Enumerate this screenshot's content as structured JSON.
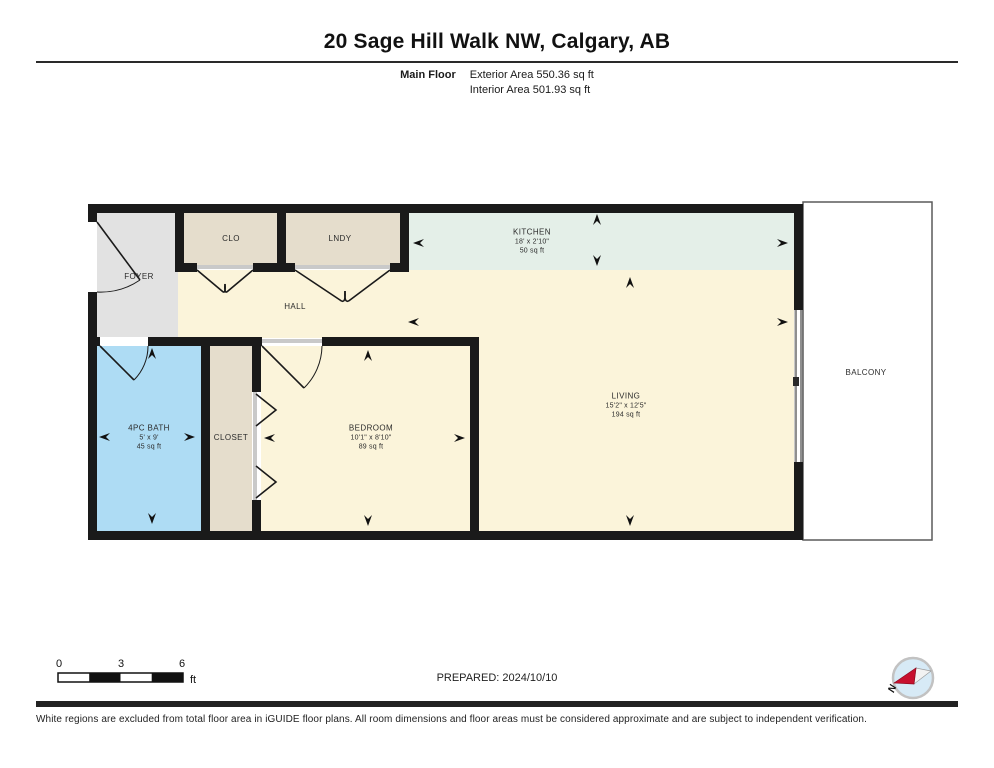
{
  "header": {
    "title": "20 Sage Hill Walk NW, Calgary, AB",
    "floor_label": "Main Floor",
    "exterior_area": "Exterior Area 550.36 sq ft",
    "interior_area": "Interior Area 501.93 sq ft"
  },
  "floor_plan": {
    "rooms": {
      "foyer": {
        "name": "FOYER"
      },
      "clo": {
        "name": "CLO"
      },
      "lndy": {
        "name": "LNDY"
      },
      "kitchen": {
        "name": "KITCHEN",
        "dims": "18' x 2'10\"",
        "area": "50 sq ft"
      },
      "hall": {
        "name": "HALL"
      },
      "living": {
        "name": "LIVING",
        "dims": "15'2\" x 12'5\"",
        "area": "194 sq ft"
      },
      "bath": {
        "name": "4PC BATH",
        "dims": "5' x 9'",
        "area": "45 sq ft"
      },
      "closet": {
        "name": "CLOSET"
      },
      "bedroom": {
        "name": "BEDROOM",
        "dims": "10'1\" x 8'10\"",
        "area": "89 sq ft"
      },
      "balcony": {
        "name": "BALCONY"
      }
    }
  },
  "scale_bar": {
    "ticks": [
      "0",
      "3",
      "6"
    ],
    "unit": "ft"
  },
  "compass": {
    "north_label": "N"
  },
  "footer": {
    "prepared": "PREPARED: 2024/10/10",
    "disclaimer": "White regions are excluded from total floor area in iGUIDE floor plans. All room dimensions and floor areas must be considered approximate and are subject to independent verification."
  },
  "colors": {
    "wall": "#1a1a1a",
    "room_cream": "#fbf4da",
    "room_kitchen": "#e4efe8",
    "room_bath": "#aedcf4",
    "room_beige": "#e5ddcc",
    "room_foyer": "#e2e2e2",
    "balcony_white": "#ffffff",
    "compass_red": "#c8102e",
    "compass_blue": "#d7eaf6"
  }
}
